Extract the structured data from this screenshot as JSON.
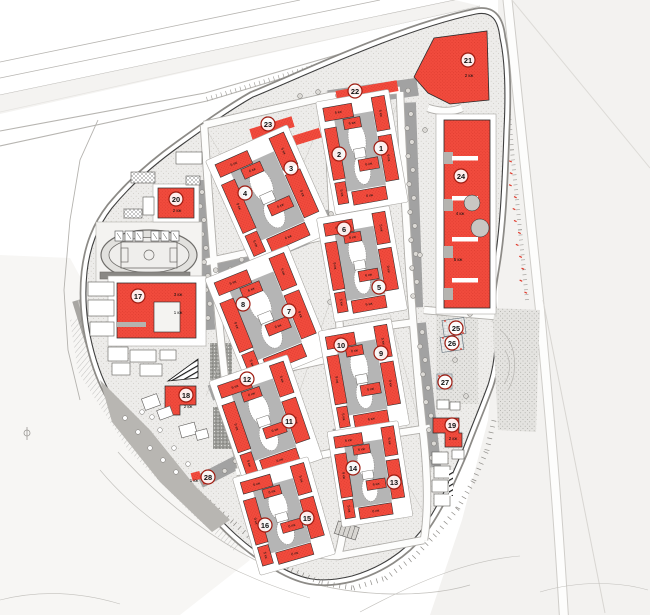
{
  "document": {
    "type": "residential-district-master-plan",
    "language": "ru"
  },
  "colors": {
    "building_red": "#f14b3d",
    "building_red_dot": "#d8372b",
    "circle_ring": "#9e1b10",
    "number_text": "#111111",
    "courtyard_gray": "#b5b5b5",
    "plaza_gray": "#a2a2a2",
    "site_bg": "#edecea",
    "outside_bg": "#f3f2f0",
    "road_edge": "#555555"
  },
  "unit_label": "кж",
  "markers": [
    {
      "n": "1",
      "x": 381,
      "y": 148
    },
    {
      "n": "2",
      "x": 339,
      "y": 154
    },
    {
      "n": "3",
      "x": 291,
      "y": 168
    },
    {
      "n": "4",
      "x": 245,
      "y": 193
    },
    {
      "n": "5",
      "x": 379,
      "y": 287
    },
    {
      "n": "6",
      "x": 344,
      "y": 229
    },
    {
      "n": "7",
      "x": 289,
      "y": 311
    },
    {
      "n": "8",
      "x": 243,
      "y": 304
    },
    {
      "n": "9",
      "x": 381,
      "y": 353
    },
    {
      "n": "10",
      "x": 341,
      "y": 345
    },
    {
      "n": "11",
      "x": 289,
      "y": 421
    },
    {
      "n": "12",
      "x": 247,
      "y": 379
    },
    {
      "n": "13",
      "x": 394,
      "y": 482
    },
    {
      "n": "14",
      "x": 353,
      "y": 468
    },
    {
      "n": "15",
      "x": 307,
      "y": 518
    },
    {
      "n": "16",
      "x": 265,
      "y": 525
    },
    {
      "n": "17",
      "x": 138,
      "y": 296
    },
    {
      "n": "18",
      "x": 186,
      "y": 395
    },
    {
      "n": "19",
      "x": 452,
      "y": 425
    },
    {
      "n": "20",
      "x": 176,
      "y": 199
    },
    {
      "n": "21",
      "x": 468,
      "y": 60
    },
    {
      "n": "22",
      "x": 355,
      "y": 91
    },
    {
      "n": "23",
      "x": 268,
      "y": 124
    },
    {
      "n": "24",
      "x": 461,
      "y": 176
    },
    {
      "n": "25",
      "x": 456,
      "y": 328
    },
    {
      "n": "26",
      "x": 452,
      "y": 343
    },
    {
      "n": "27",
      "x": 445,
      "y": 382
    },
    {
      "n": "28",
      "x": 208,
      "y": 477
    }
  ],
  "clusters": [
    {
      "id": "3-4",
      "cx": 270,
      "cy": 196,
      "w": 80,
      "h": 106,
      "rot": -24
    },
    {
      "id": "1-2",
      "cx": 362,
      "cy": 152,
      "w": 66,
      "h": 104,
      "rot": -10
    },
    {
      "id": "5-6",
      "cx": 362,
      "cy": 264,
      "w": 66,
      "h": 96,
      "rot": -10
    },
    {
      "id": "7-8",
      "cx": 268,
      "cy": 316,
      "w": 80,
      "h": 106,
      "rot": -22
    },
    {
      "id": "9-10",
      "cx": 364,
      "cy": 378,
      "w": 66,
      "h": 98,
      "rot": -10
    },
    {
      "id": "11-12",
      "cx": 266,
      "cy": 420,
      "w": 74,
      "h": 100,
      "rot": -19
    },
    {
      "id": "13-14",
      "cx": 370,
      "cy": 474,
      "w": 64,
      "h": 88,
      "rot": -9
    },
    {
      "id": "15-16",
      "cx": 284,
      "cy": 516,
      "w": 70,
      "h": 92,
      "rot": -16
    }
  ],
  "cluster_bars": [
    {
      "fx": 0.03,
      "fy": 0.02,
      "fw": 0.44,
      "fh": 0.13,
      "label": "6 кж",
      "v": false
    },
    {
      "fx": 0.78,
      "fy": 0.0,
      "fw": 0.2,
      "fh": 0.33,
      "label": "5 кж",
      "v": true
    },
    {
      "fx": 0.0,
      "fy": 0.22,
      "fw": 0.18,
      "fh": 0.5,
      "label": "9 кж",
      "v": true
    },
    {
      "fx": 0.78,
      "fy": 0.38,
      "fw": 0.2,
      "fh": 0.44,
      "label": "9 кж",
      "v": true
    },
    {
      "fx": 0.24,
      "fy": 0.86,
      "fw": 0.52,
      "fh": 0.13,
      "label": "6 кж",
      "v": false
    },
    {
      "fx": 0.01,
      "fy": 0.75,
      "fw": 0.16,
      "fh": 0.21,
      "label": "5 кж",
      "v": true
    },
    {
      "fx": 0.42,
      "fy": 0.57,
      "fw": 0.3,
      "fh": 0.11,
      "label": "6 кж",
      "v": false
    },
    {
      "fx": 0.3,
      "fy": 0.16,
      "fw": 0.26,
      "fh": 0.1,
      "label": "6 кж",
      "v": false
    }
  ],
  "floor_labels": [
    {
      "text": "2 кж",
      "x": 177,
      "y": 212
    },
    {
      "text": "2 кж",
      "x": 188,
      "y": 408
    },
    {
      "text": "2 кж",
      "x": 453,
      "y": 440
    },
    {
      "text": "2 кж",
      "x": 469,
      "y": 77
    },
    {
      "text": "4 кж",
      "x": 460,
      "y": 215
    },
    {
      "text": "5 кж",
      "x": 458,
      "y": 261
    },
    {
      "text": "3 кж",
      "x": 178,
      "y": 296
    },
    {
      "text": "1 кж",
      "x": 178,
      "y": 314
    },
    {
      "text": "1 кж",
      "x": 194,
      "y": 482
    }
  ]
}
